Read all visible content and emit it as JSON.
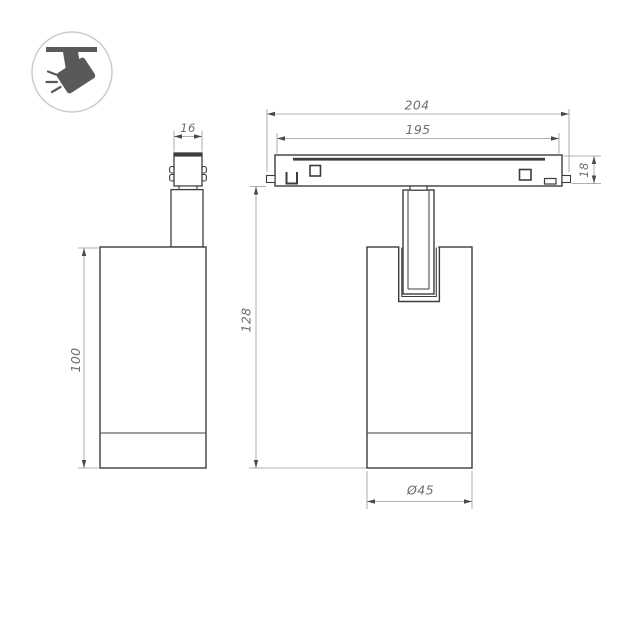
{
  "page": {
    "background": "#ffffff",
    "description_label": "track-spotlight-dimension-drawing"
  },
  "colors": {
    "outline": "#3d3d3d",
    "dimension_lines": "#979797",
    "dimension_text": "#6e6e6e",
    "arrowhead": "#4a4a4a",
    "icon_glyph": "#58595b",
    "icon_ring": "#cccccc",
    "background": "#ffffff"
  },
  "icon_badge": {
    "name": "track-spotlight-icon"
  },
  "views": {
    "side": {
      "dims": {
        "adapter_width": "16",
        "body_height": "100"
      }
    },
    "front": {
      "dims": {
        "track_outer_length": "204",
        "track_window_length": "195",
        "track_height": "18",
        "overall_height": "128",
        "body_diameter": "Ø45"
      }
    }
  }
}
